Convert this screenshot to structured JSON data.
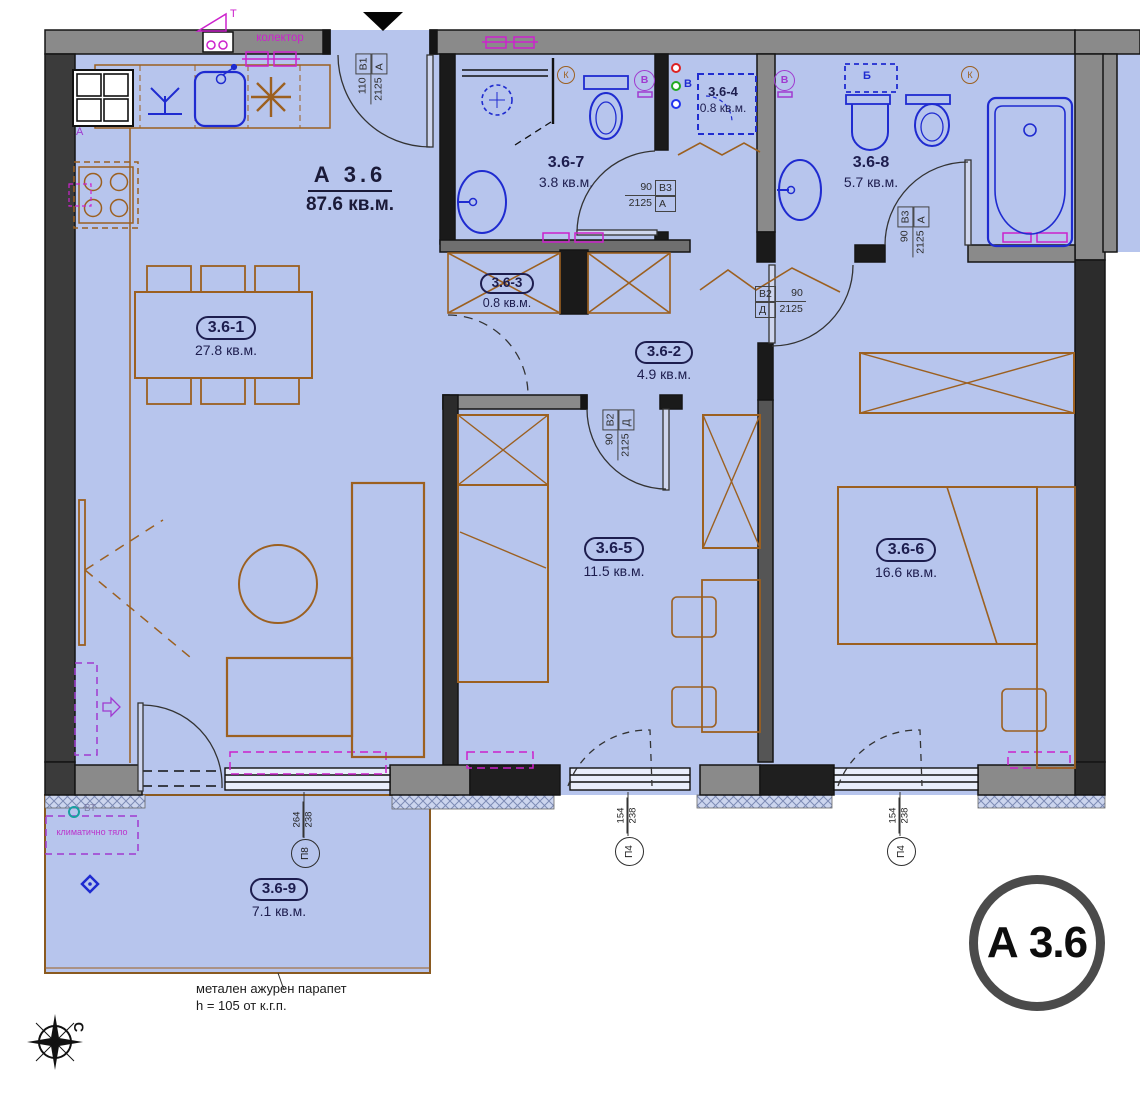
{
  "title": {
    "code": "А 3.6",
    "area": "87.6 кв.м."
  },
  "badge": {
    "label": "А 3.6"
  },
  "rooms": [
    {
      "id": "3.6-1",
      "area": "27.8 кв.м."
    },
    {
      "id": "3.6-2",
      "area": "4.9 кв.м."
    },
    {
      "id": "3.6-3",
      "area": "0.8 кв.м."
    },
    {
      "id": "3.6-4",
      "area": "0.8 кв.м."
    },
    {
      "id": "3.6-5",
      "area": "11.5 кв.м."
    },
    {
      "id": "3.6-6",
      "area": "16.6 кв.м."
    },
    {
      "id": "3.6-7",
      "area": "3.8 кв.м."
    },
    {
      "id": "3.6-8",
      "area": "5.7 кв.м."
    },
    {
      "id": "3.6-9",
      "area": "7.1 кв.м."
    }
  ],
  "door_tags": {
    "entrance": {
      "c00": "110",
      "c01": "В1",
      "c10": "2125",
      "c11": "А"
    },
    "bath7": {
      "c00": "90",
      "c01": "В3",
      "c10": "2125",
      "c11": "А"
    },
    "bath8": {
      "c00": "90",
      "c01": "В3",
      "c10": "2125",
      "c11": "А"
    },
    "bedroom6": {
      "c00": "В2",
      "c01": "90",
      "c10": "Д",
      "c11": "2125"
    },
    "bedroom5": {
      "c00": "90",
      "c01": "В2",
      "c10": "2125",
      "c11": "Д"
    }
  },
  "window_tags": {
    "p8": {
      "label": "П8",
      "width": "264",
      "height": "238"
    },
    "p4a": {
      "label": "П4",
      "width": "154",
      "height": "238"
    },
    "p4b": {
      "label": "П4",
      "width": "154",
      "height": "238"
    }
  },
  "annotations": {
    "kolektor": "колектор",
    "klimatichno": "климатично тяло",
    "vt": "ВТ",
    "parapet_line1": "метален ажурен парапет",
    "parapet_line2": "h = 105 от к.г.п.",
    "compass_north": "С",
    "boiler_b": "Б",
    "breaker_v": "В",
    "k_bath7": "К",
    "k_bath8": "К",
    "v_bath7": "В",
    "v_bath8": "В",
    "a_kitchen": "А",
    "t_flag": "Т"
  },
  "colors": {
    "floor": "#b7c5ed",
    "wall_gray": "#8a8a8a",
    "wall_dark": "#2f2f2f",
    "furniture": "#9c6020",
    "fixture": "#1f2bd0",
    "magenta": "#cc22cc",
    "purple": "#a03ad0",
    "label": "#1d1d4e"
  }
}
